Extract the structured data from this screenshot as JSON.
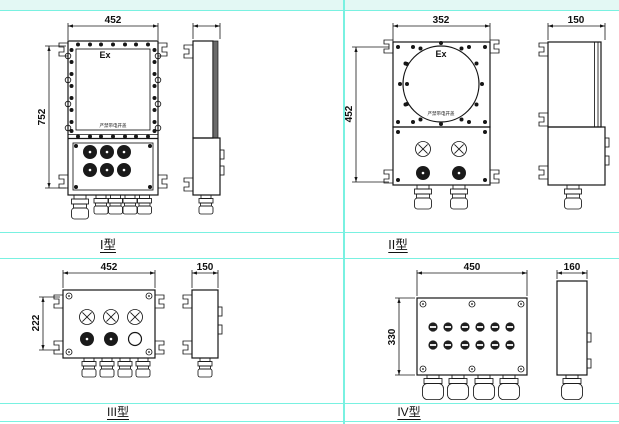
{
  "page": {
    "background": "#ffffff",
    "accent_cyan": "#79f1e1",
    "band_fill": "#e3f8f4",
    "line_color": "#161616"
  },
  "types": {
    "t1": {
      "label": "I型",
      "ex_mark": "Ex",
      "warning": "严禁带电开盖",
      "dim_width": "452",
      "dim_height": "752"
    },
    "t2": {
      "label": "II型",
      "ex_mark": "Ex",
      "warning": "严禁带电开盖",
      "dim_width": "352",
      "dim_height": "452",
      "dim_depth": "150"
    },
    "t3": {
      "label": "III型",
      "dim_width": "452",
      "dim_height": "222",
      "dim_depth": "150"
    },
    "t4": {
      "label": "IV型",
      "dim_width": "450",
      "dim_height": "330",
      "dim_depth": "160"
    }
  }
}
